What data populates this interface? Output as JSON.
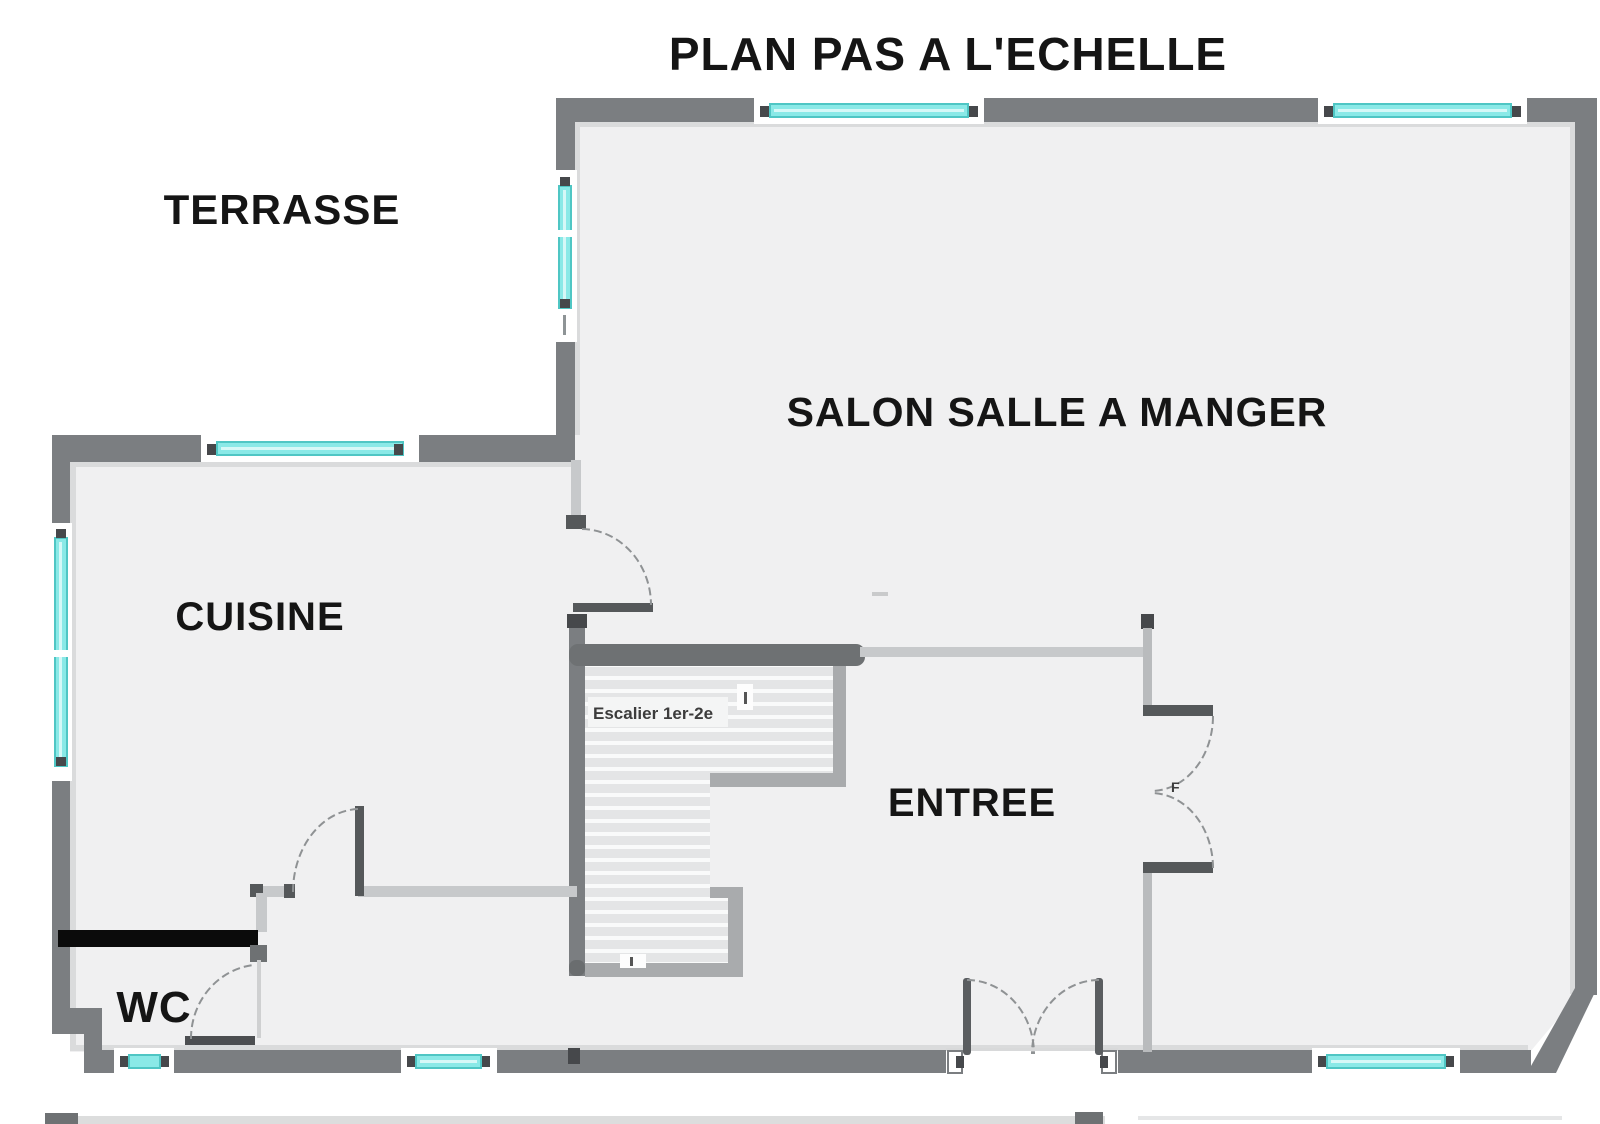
{
  "title": "PLAN PAS A L'ECHELLE",
  "rooms": {
    "terrasse": "TERRASSE",
    "salon": "SALON SALLE A MANGER",
    "cuisine": "CUISINE",
    "entree": "ENTREE",
    "wc": "WC"
  },
  "stairs": {
    "label": "Escalier 1er-2e"
  },
  "doors": {
    "french_door_label": "F"
  },
  "colors": {
    "wall": "#7b7e81",
    "wall_dark": "#55585a",
    "wall_light": "#c7c9cb",
    "floor": "#f0f0f1",
    "window_glass": "#8ae9e7",
    "window_frame": "#4fc6c4",
    "stair_border": "#a9abad",
    "stair_tread": "#e4e5e6",
    "highlighted_wall": "#0b0b0b",
    "background": "#ffffff"
  }
}
